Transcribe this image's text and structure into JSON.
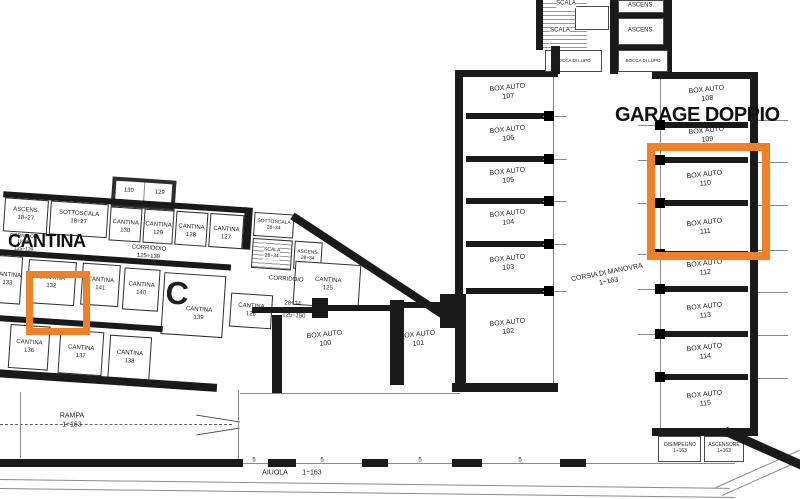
{
  "colors": {
    "highlight": "#F08126",
    "wall": "#1a1a1a"
  },
  "annotations": {
    "cantina": "CANTINA",
    "garage_doppio": "GARAGE DOPPIO",
    "block_letter": "C"
  },
  "core": {
    "scala": "SCALA",
    "ascens": "ASCENS.",
    "bocca": "BOCCA DI LUPO"
  },
  "garage": {
    "stall_word": "BOX AUTO",
    "left_stalls": [
      "107",
      "106",
      "105",
      "104",
      "103",
      "102"
    ],
    "right_stalls": [
      "108",
      "109",
      "110",
      "111",
      "112",
      "113",
      "114",
      "115"
    ],
    "mid_stalls": [
      "100",
      "101"
    ],
    "aisle_label": "CORSIA DI MANOVRA",
    "quota_full": "1÷163",
    "disimpegno": "DISIMPEGNO",
    "ascensore": "ASCENSORE"
  },
  "cantine": {
    "word": "CANTINA",
    "ascens": "ASCENS.",
    "sottoscala": "SOTTOSCALA",
    "scala": "SCALA",
    "corridoio": "CORRIDOIO",
    "quota_18_27": "18÷27",
    "quota_28_34": "28÷34",
    "quota_125_139": "125÷139",
    "quota_125_150": "125÷150",
    "top_numbers": [
      "130",
      "129",
      "128",
      "127"
    ],
    "attic_numbers": [
      "130",
      "129"
    ],
    "row_b_numbers": [
      "133",
      "132",
      "141",
      "140",
      "139",
      "125",
      "126"
    ],
    "row_c_numbers": [
      "136",
      "137",
      "138"
    ]
  },
  "site": {
    "rampa": "RAMPA",
    "aiuola": "AIUOLA",
    "quota_full": "1÷163",
    "dash_mark": "5"
  }
}
